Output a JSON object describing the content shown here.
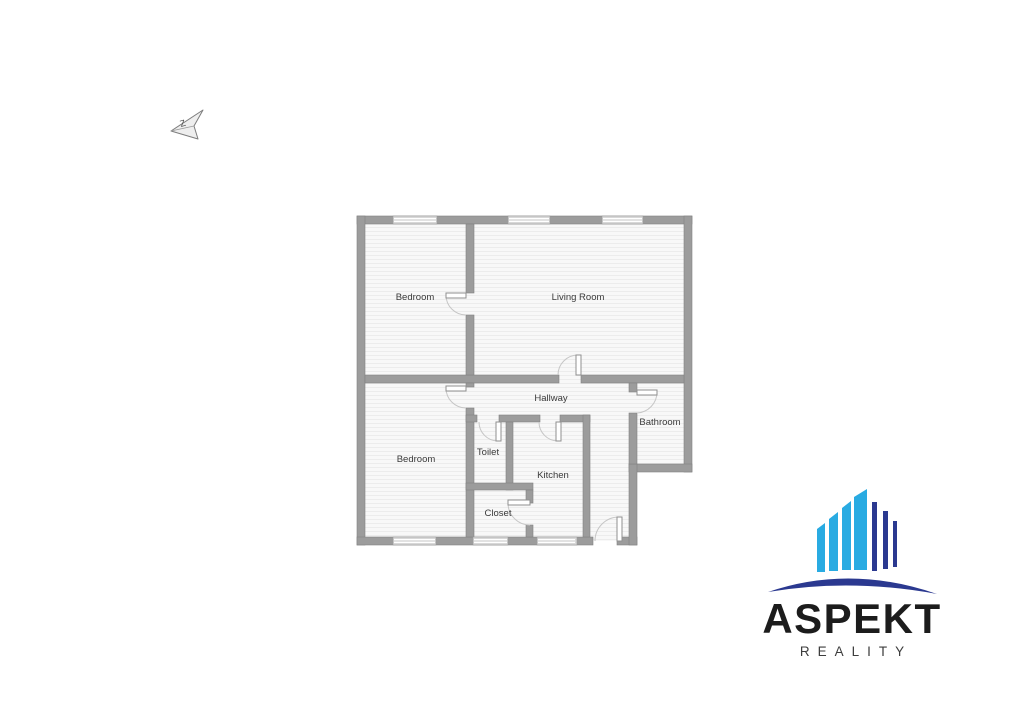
{
  "compass": {
    "direction_label": "Z"
  },
  "floor_plan": {
    "rooms": [
      {
        "id": "bedroom-1",
        "label": "Bedroom"
      },
      {
        "id": "living-room",
        "label": "Living Room"
      },
      {
        "id": "bedroom-2",
        "label": "Bedroom"
      },
      {
        "id": "hallway",
        "label": "Hallway"
      },
      {
        "id": "toilet",
        "label": "Toilet"
      },
      {
        "id": "kitchen",
        "label": "Kitchen"
      },
      {
        "id": "bathroom",
        "label": "Bathroom"
      },
      {
        "id": "closet",
        "label": "Closet"
      }
    ],
    "colors": {
      "wall": "#9c9c9c",
      "floor": "#f7f7f7",
      "floor_stripe": "#ebebeb",
      "window": "#d8d8d8",
      "door_arc": "#c6c6c6"
    }
  },
  "logo": {
    "brand": "ASPEKT",
    "subtitle": "REALITY",
    "colors": {
      "building_light_blue": "#29abe2",
      "building_dark_blue": "#2b3990",
      "swoosh": "#2b3990",
      "brand_text": "#1c1c1c",
      "subtitle_text": "#3d3d3d"
    }
  }
}
